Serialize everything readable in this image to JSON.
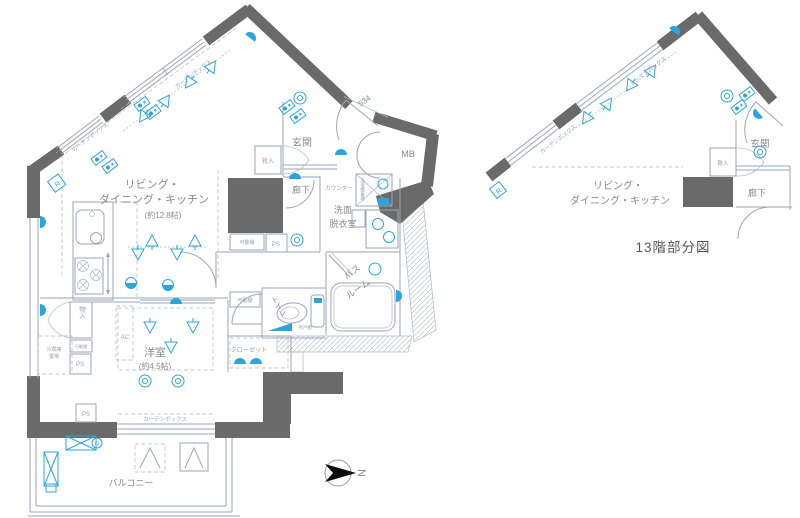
{
  "colors": {
    "wall": "#6a6a6a",
    "line": "#9aa6b8",
    "accent": "#2ba6db",
    "label": "#8b8b8b",
    "caption": "#555555"
  },
  "main_plan": {
    "ldk": {
      "line1": "リビング・",
      "line2": "ダイニング・キッチン",
      "size": "(約12.8帖)"
    },
    "entrance": "玄関",
    "shoe_box": "靴入",
    "hallway": "廊下",
    "counter": "カウンター",
    "washroom": {
      "line1": "洗面",
      "line2": "脱衣室"
    },
    "laundry": "洗濯機置場",
    "bath": {
      "line1": "バス",
      "line2": "ルーム"
    },
    "toilet": "トイレ",
    "hanging_shelf": "吊戸棚",
    "closet": "クローゼット",
    "storage": "物入",
    "fridge": {
      "line1": "冷蔵庫",
      "line2": "置場"
    },
    "western_room": {
      "name": "洋室",
      "size": "(約4.5帖)"
    },
    "balcony": "バルコニー",
    "meter_box": "MB",
    "movable_shelf": "可動棚",
    "pipe_space": "PS",
    "ac": "AC",
    "curtain_box": "カーテンボックス",
    "dim_534": "534",
    "mark_r": "R",
    "mark_g": "G"
  },
  "partial_plan": {
    "caption": "13階部分図",
    "ldk": {
      "line1": "リビング・",
      "line2": "ダイニング・キッチン"
    },
    "entrance": "玄関",
    "shoe_box": "靴入",
    "hallway": "廊下",
    "curtain_box": "カーテンボックス",
    "mark_r": "R"
  },
  "compass": {
    "north": "N"
  }
}
